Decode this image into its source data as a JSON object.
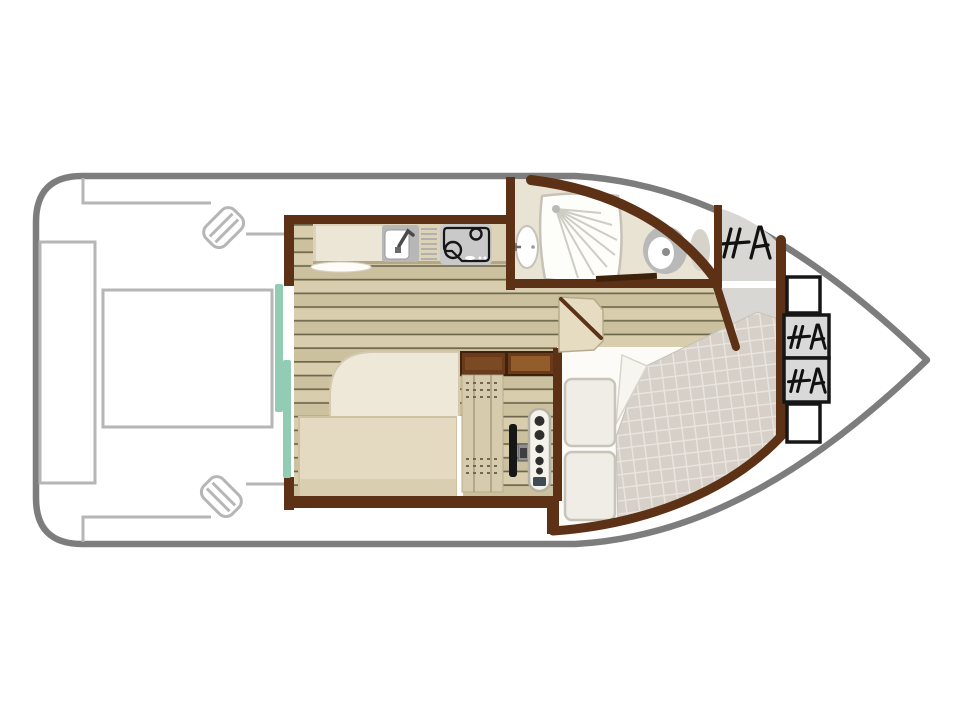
{
  "plan": {
    "kind": "houseboat-floor-plan",
    "rooms": [
      "aft-deck",
      "galley",
      "bathroom",
      "saloon",
      "helm-station",
      "bow-cabin",
      "anchor-locker"
    ],
    "fixtures": [
      "aft-bench",
      "aft-table",
      "boarding-step",
      "sliding-door",
      "kitchen-counter",
      "kitchen-sink",
      "stove",
      "shower",
      "washbasin",
      "toilet",
      "bathroom-door",
      "sofa",
      "helm-seat",
      "storage-cabinets",
      "steering-wheel",
      "instrument-panel",
      "cabin-door",
      "double-bed",
      "pillow",
      "anchor-locker-hatch",
      "bow-steps"
    ]
  },
  "colors": {
    "page": "#ffffff",
    "hull_outline": "#7d7d7d",
    "deck_line": "#b6b6b6",
    "wall": "#5d3115",
    "wall_dark": "#3f220c",
    "plank_a": "#d8cead",
    "plank_b": "#ccc19f",
    "plank_line": "#6e674b",
    "counter": "#ddd3b8",
    "cupboard": "#ece6d7",
    "counter_edge": "#b3a784",
    "appliance_gray": "#c9c9c9",
    "sink_gray": "#b7b7b7",
    "white": "#ffffff",
    "bath_floor": "#e9e3d3",
    "fixture_gray": "#b9b9b9",
    "fixture_light": "#d6d3cb",
    "fixture_edge": "#c6c2b8",
    "shower_line": "#cfccc3",
    "gray_floor": "#d9d7d3",
    "quilt": "#d6d0c9",
    "quilt_line": "#e9e5df",
    "sheet_white": "#fcfbf7",
    "pillow": "#efede6",
    "pillow_edge": "#c7c4b9",
    "sofa_top": "#eee8d9",
    "sofa_edge": "#d5cab1",
    "bench": "#e4dac1",
    "bench_dark": "#d9ceb0",
    "bench_edge": "#cec2a3",
    "seat": "#d6cbac",
    "seat_mark": "#6e6751",
    "cabinet": "#6b3a1b",
    "cabinet_inner": "#935c2b",
    "teal": "#93ccb4",
    "black": "#161616",
    "panel": "#f5f2ea",
    "panel_edge": "#b5b1a6",
    "panel_knob": "#2e2e2e",
    "panel_screen": "#3f4a55",
    "hub_gray": "#8f8f8f",
    "hub_dark": "#3f3f3f",
    "door_leaf": "#e6dcc2",
    "door_leaf_edge": "#b7ab8d",
    "hatch_mark": "#111111",
    "step_box_gray": "#d9d9d9",
    "dish": "#fdfcf8"
  }
}
